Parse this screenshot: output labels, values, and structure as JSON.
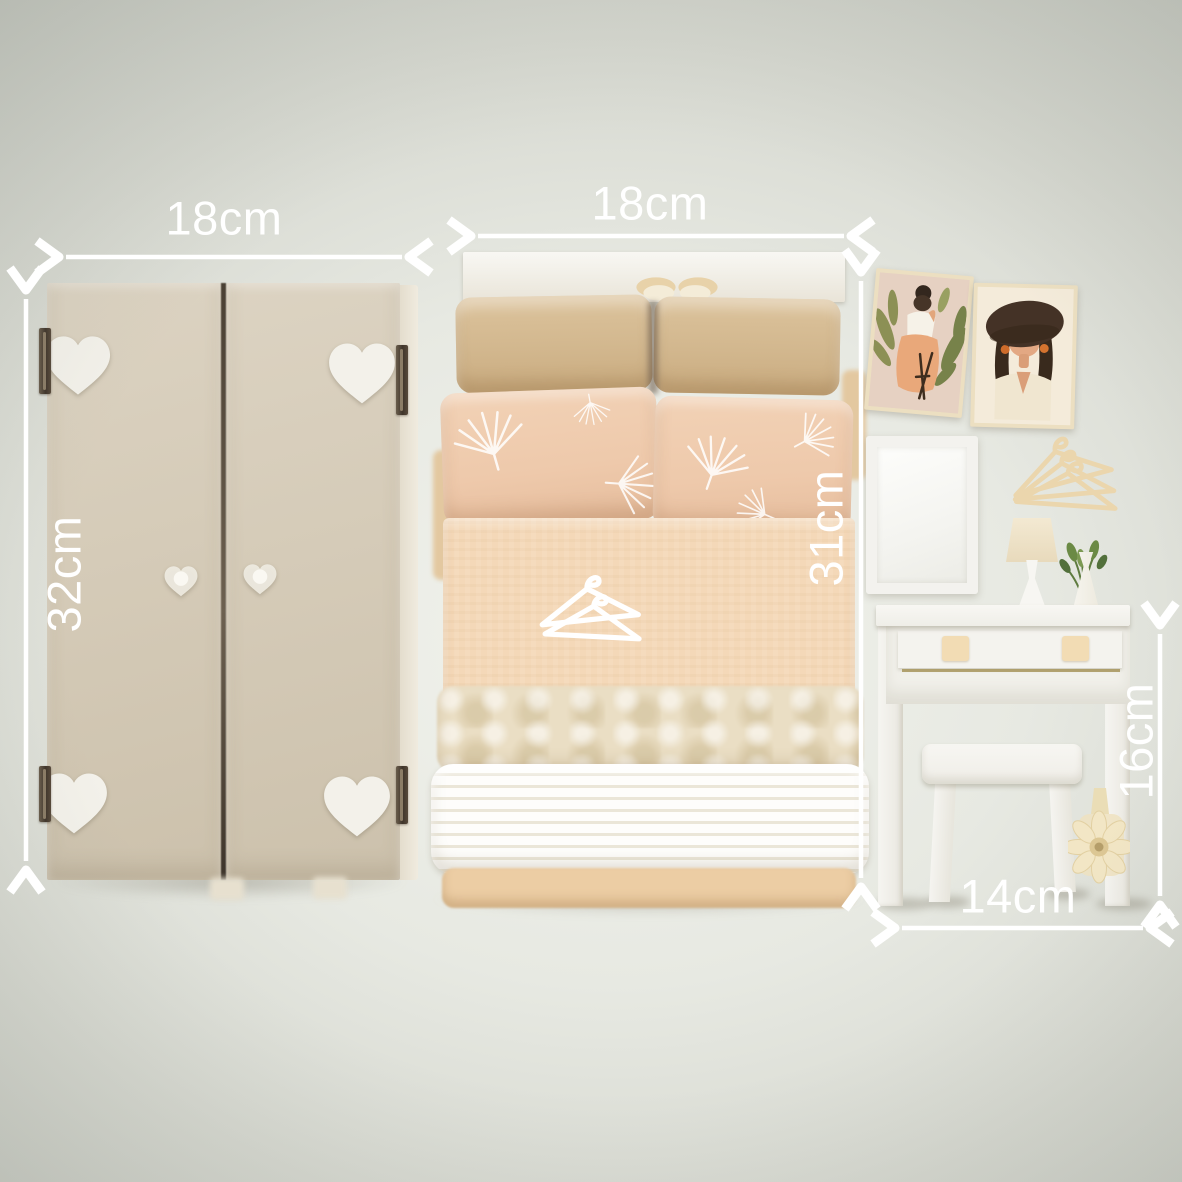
{
  "annotations": {
    "color": "#ffffff",
    "wardrobe": {
      "width_label": "18cm",
      "height_label": "32cm"
    },
    "bed": {
      "width_label": "18cm",
      "length_label": "31cm"
    },
    "vanity": {
      "height_label": "16cm",
      "width_label": "14cm"
    }
  },
  "palette": {
    "background_edge": "#c7cac2",
    "background_center": "#f2f3ed",
    "wardrobe_beige": "#d3c9b5",
    "heart_white": "#f3f1ea",
    "pillow_tan": "#d7bd95",
    "pillow_blush": "#eec9ab",
    "bedspread_peach": "#f4d8b8",
    "blanket_cream": "#eadec4",
    "blanket_white": "#f8f5ec",
    "furniture_white": "#f4f3ef",
    "hanger_wood": "#ebd6ad",
    "leaf_green": "#6b8a45",
    "brass_accent": "#a29052"
  },
  "icons": {
    "heart_decoration": "heart",
    "clothes_hanger": "hanger",
    "pillow_print": "ginkgo-fan",
    "daisy_flower": "daisy"
  }
}
